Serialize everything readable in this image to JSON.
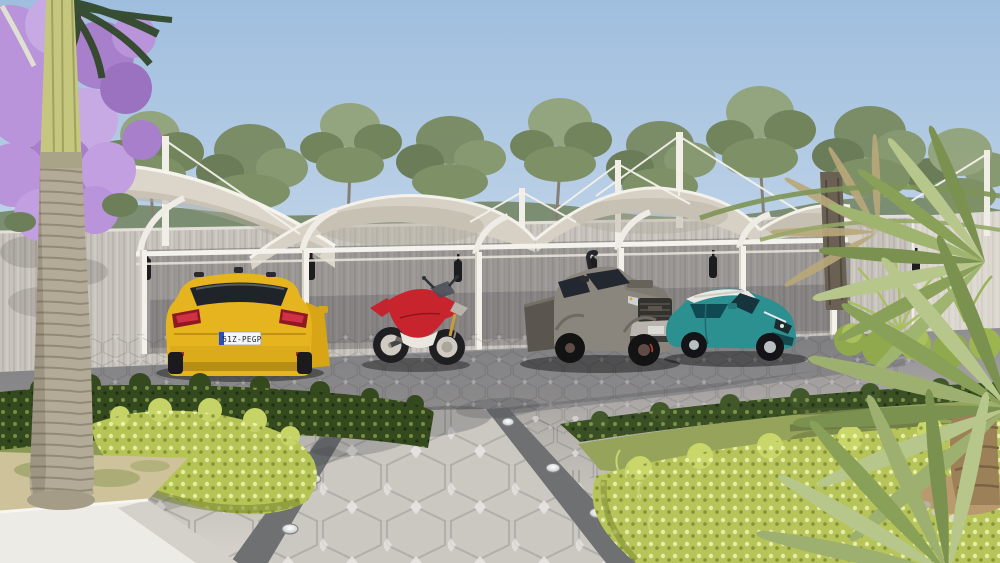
{
  "scene": {
    "title": "Carport shade canopy – exterior 3D render",
    "medium": "photorealistic architectural visualization",
    "sky": {
      "top": "#9fbede",
      "horizon": "#dce8f2"
    },
    "background": {
      "treeline": "eucalyptus trees above boundary wall",
      "wall_color": "#c7c3bc"
    },
    "canopy": {
      "label": "white tensile-membrane carport canopy",
      "fabric_color": "#dcd6ca",
      "frame_color": "#f3f1ea",
      "bays": 4,
      "posts": 6,
      "masts": 5,
      "wall_lamps": 6
    },
    "vehicles": [
      {
        "name": "yellow-suv",
        "body_color": "#e6b41f",
        "license_plate": "51Z-PEGP",
        "position": "left bay, rear view"
      },
      {
        "name": "red-sport-motorcycle",
        "body_color": "#c8242e",
        "position": "second bay"
      },
      {
        "name": "grey-pickup-truck",
        "body_color": "#8b867d",
        "position": "third bay"
      },
      {
        "name": "teal-crossover-suv",
        "body_color": "#2c8f90",
        "roof_color": "#eae8e2",
        "position": "right bay"
      }
    ],
    "ground": {
      "paving": "hexagonal concrete pavers with white diamond inserts",
      "pavement_color": "#c9c5bf",
      "shade_color": "#6e6d72",
      "walkway_border_color": "#6e7072",
      "ground_lights": 7
    },
    "landscape": {
      "left": [
        "jacaranda tree in purple bloom",
        "tall palm tree",
        "white concrete planter",
        "dark green hedge",
        "bright hedge"
      ],
      "right": [
        "fan palm fronds",
        "lawn with palm shadow",
        "yellow-green hedge",
        "sunlit ferns"
      ],
      "lawn_color": "#96a35a",
      "hedge_dark": "#35491f",
      "hedge_bright": "#b5c455",
      "bloom_color": "#b893d8",
      "palm_trunk": "#b3ab98"
    }
  }
}
